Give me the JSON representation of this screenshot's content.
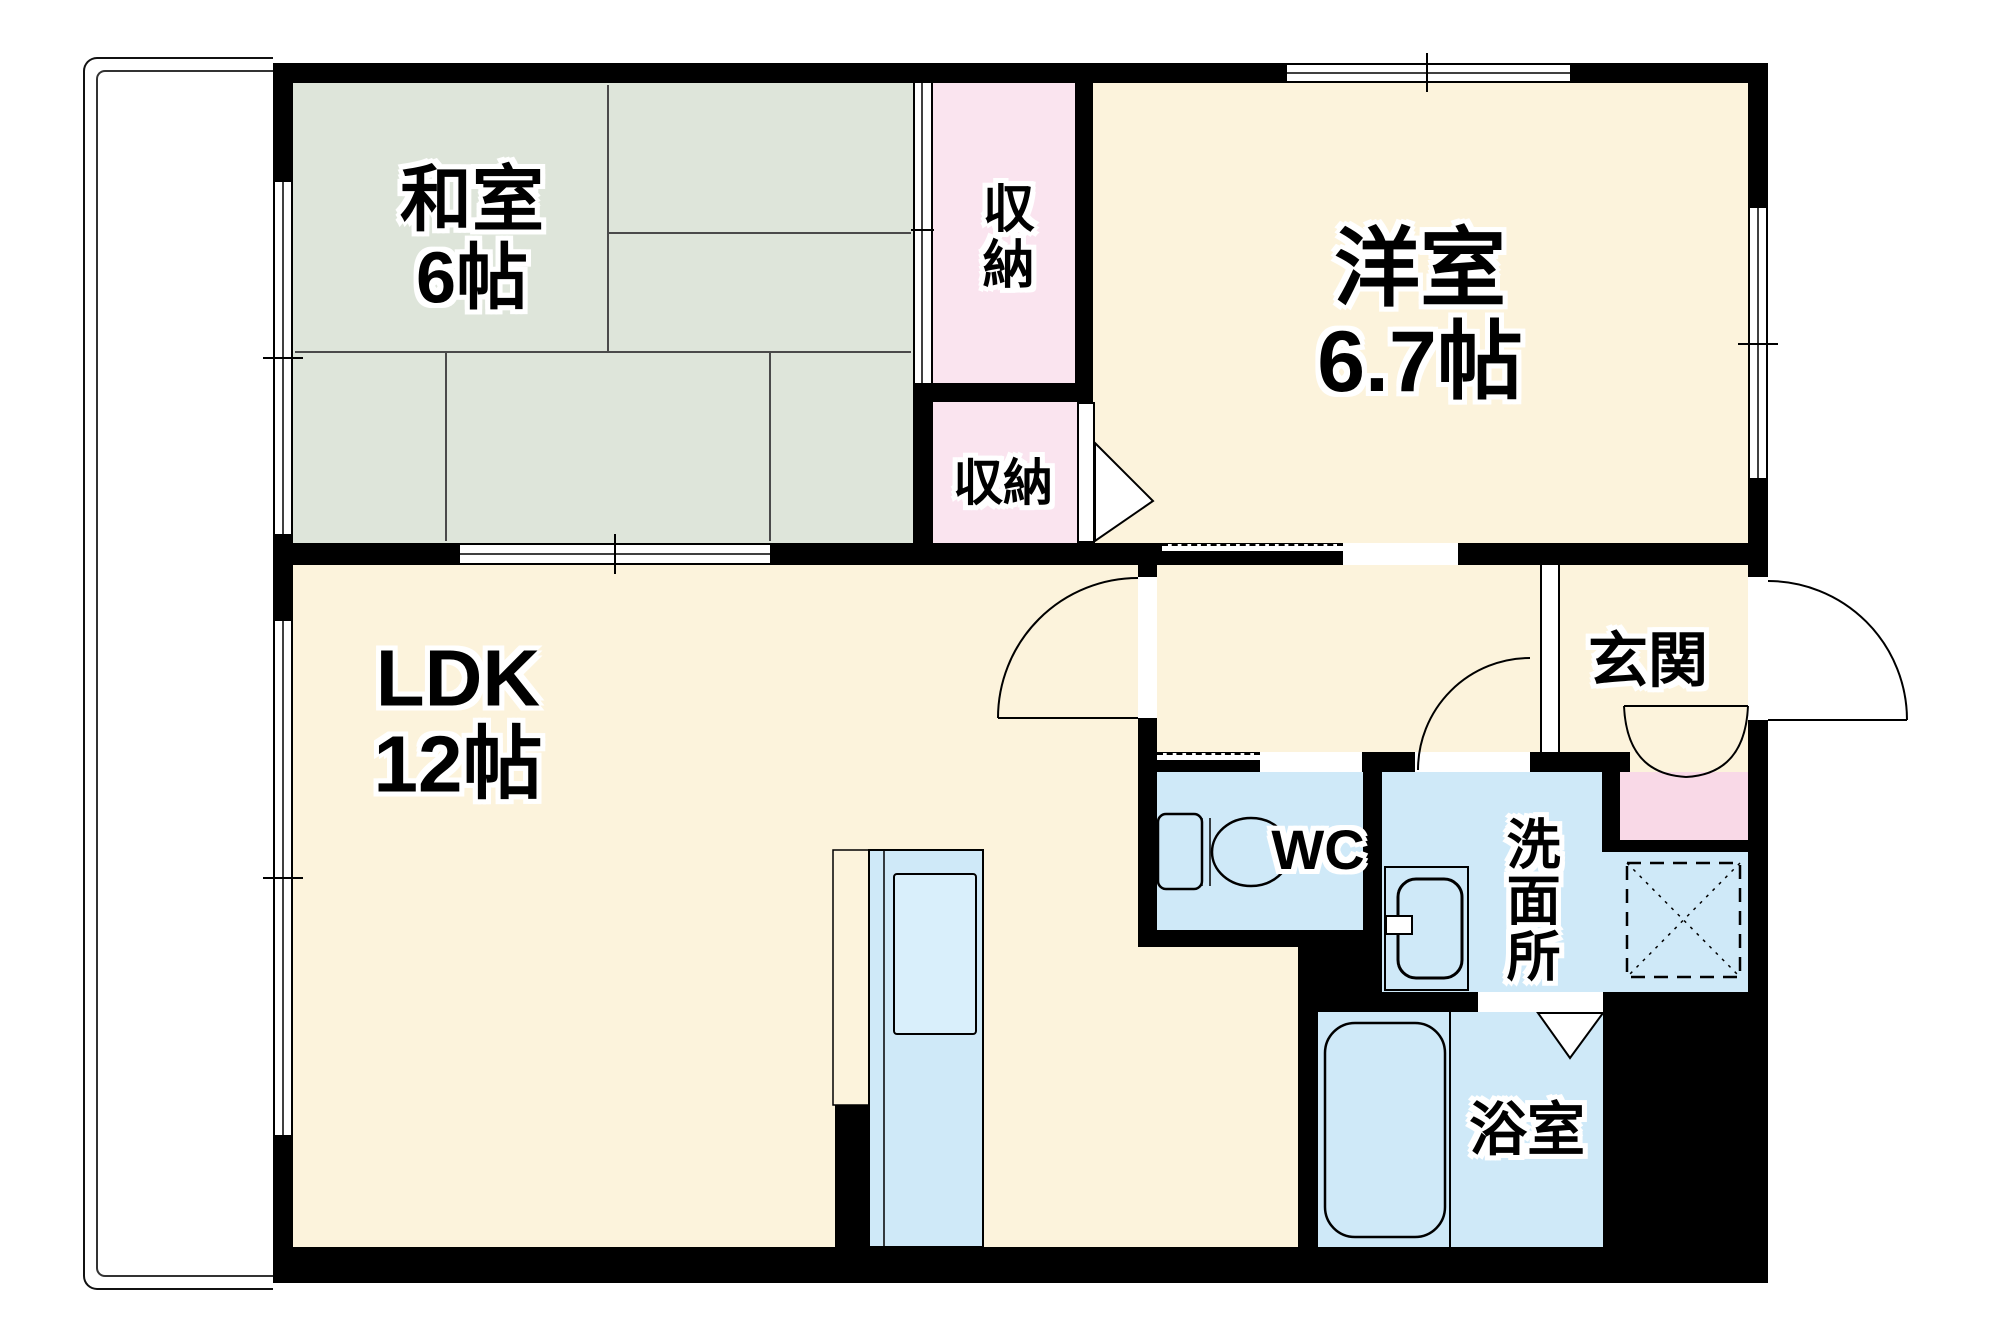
{
  "plan": {
    "type": "floor-plan",
    "rooms": {
      "washitsu": {
        "label": "和室",
        "size": "6帖"
      },
      "closet_upper": {
        "label": "収納"
      },
      "closet_lower": {
        "label": "収納"
      },
      "youshitsu": {
        "label": "洋室",
        "size": "6.7帖"
      },
      "ldk": {
        "label": "LDK",
        "size": "12帖"
      },
      "genkan": {
        "label": "玄関"
      },
      "wc": {
        "label": "WC"
      },
      "senmenjo": {
        "label": "洗面所"
      },
      "yokushitsu": {
        "label": "浴室"
      }
    },
    "colors": {
      "wall": "#000000",
      "tatami_green": "#dee5da",
      "room_cream": "#fcf3dc",
      "closet_pink": "#fae4ef",
      "wet_area_blue": "#cfe9f8",
      "cabinet_pink": "#f9d9e7",
      "background": "#ffffff"
    }
  }
}
